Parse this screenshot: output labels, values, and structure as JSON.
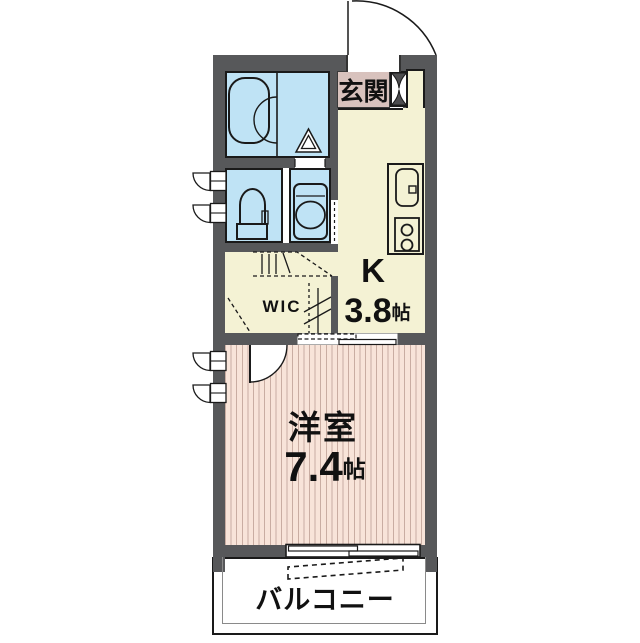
{
  "floorplan": {
    "entrance": {
      "label": "玄関"
    },
    "kitchen": {
      "label": "K",
      "size_value": "3.8",
      "size_unit": "帖"
    },
    "wic": {
      "label": "WIC"
    },
    "main_room": {
      "label": "洋室",
      "size_value": "7.4",
      "size_unit": "帖"
    },
    "balcony": {
      "label": "バルコニー"
    },
    "colors": {
      "wall": "#57585A",
      "wet_area": "#BFE3F5",
      "floor_cream": "#F4F2D4",
      "genkan": "#D8C2BD",
      "flooring": "#F8E4D9",
      "flooring_stripe": "#C9ADA2"
    },
    "fixtures": [
      "entrance-door-swing",
      "shoe-cabinet",
      "bathtub",
      "bath-folding-door",
      "toilet",
      "washbasin",
      "kitchen-sink",
      "gas-stove-2-burner",
      "hanger-pipe",
      "sliding-door",
      "casement-window",
      "sliding-window",
      "eaves-dashed-outline"
    ]
  }
}
